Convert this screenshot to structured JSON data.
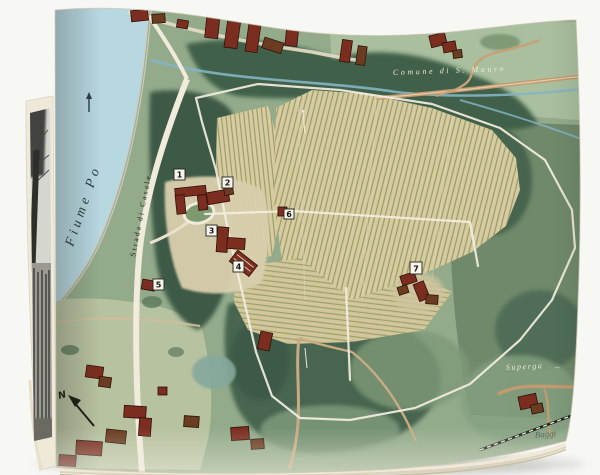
{
  "scene": {
    "kind": "photograph of an open art book",
    "background_color": "#f7f7f4"
  },
  "left_page": {
    "content_description": "black-and-white photograph of trees",
    "paper_color": "#efe9da"
  },
  "map": {
    "labels": {
      "river": "Fiume Po",
      "road": "Strada di Casale",
      "commune": "Comune di S. Mauro",
      "destination": "Superga",
      "destination_arrow": "→",
      "north": "N",
      "signature": "Baggi"
    },
    "markers": [
      {
        "number": "1"
      },
      {
        "number": "2"
      },
      {
        "number": "3"
      },
      {
        "number": "4"
      },
      {
        "number": "5"
      },
      {
        "number": "6"
      },
      {
        "number": "7"
      }
    ],
    "colors": {
      "river_blue": "#b7d7e1",
      "sand": "#dbcfae",
      "base_green": "#93ab8b",
      "field_light_green": "#a9bf9e",
      "forest_dark_green": "#40604a",
      "vineyard_tan": "#d7cb9f",
      "vine_row_olive": "#8d9662",
      "road_white": "#f3eee0",
      "road_tan": "#c49a6f",
      "stream_blue": "#84b4c4",
      "roof_red": "#7b2d1f",
      "marker_box": "#f6f4ec",
      "ink": "#23231c"
    }
  }
}
